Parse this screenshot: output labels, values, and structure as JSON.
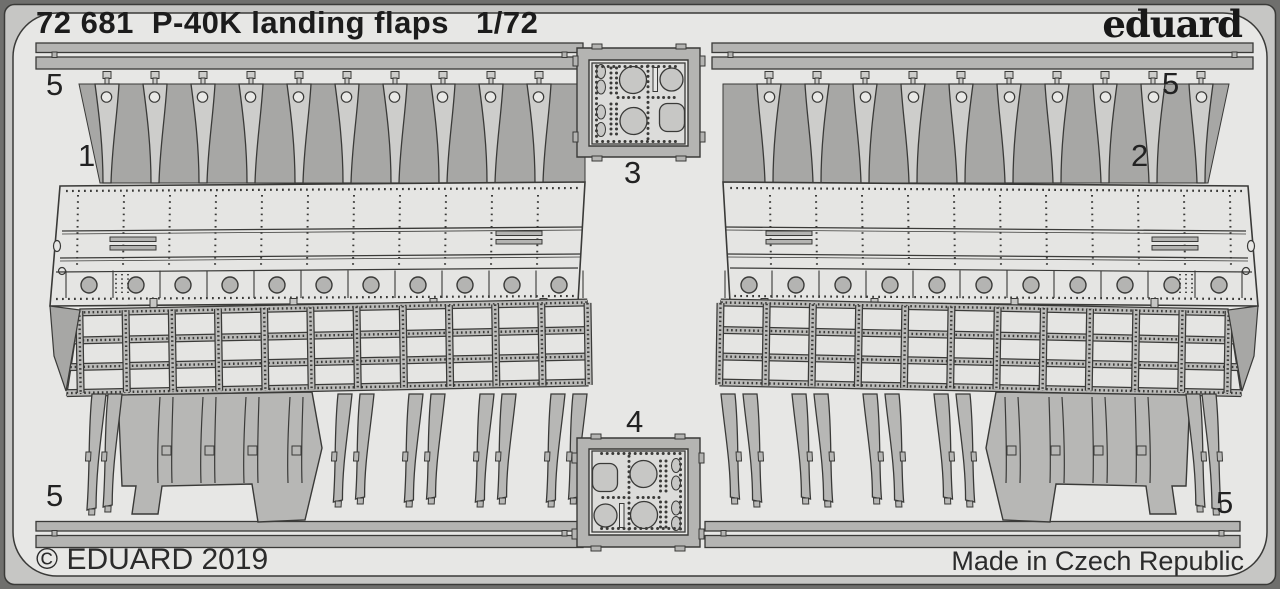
{
  "header": {
    "catalog_number": "72 681",
    "title": "P-40K landing flaps",
    "scale": "1/72"
  },
  "brand": {
    "logo_text": "eduard"
  },
  "footer": {
    "copyright": "© EDUARD 2019",
    "made_in": "Made in Czech Republic"
  },
  "part_labels": {
    "strip_top_left": "5",
    "flap_left": "1",
    "detail_top": "3",
    "strip_top_right": "5",
    "flap_right": "2",
    "detail_bottom": "4",
    "strip_bottom_left": "5",
    "strip_bottom_right": "5"
  },
  "colors": {
    "frame_outer": "#6f6f6d",
    "frame_rail": "#c6c6c4",
    "sheet": "#e7e7e5",
    "part": "#cdcdcb",
    "part_dark": "#b4b4b2",
    "waste_band": "#a7a7a5",
    "panel": "#e5e5e3",
    "lattice_member": "#bbbbb9",
    "slab": "#b7b7b5",
    "hole": "#e9e9e7",
    "detail_fill": "#c7c7c5",
    "outline": "#3a3a38",
    "text": "#1c1c1c"
  }
}
